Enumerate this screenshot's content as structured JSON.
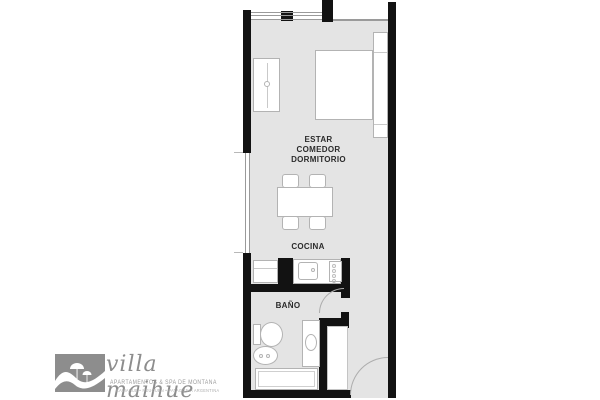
{
  "floorplan": {
    "labels": {
      "living": [
        "ESTAR",
        "COMEDOR",
        "DORMITORIO"
      ],
      "kitchen": "COCINA",
      "bathroom": "BAÑO"
    },
    "colors": {
      "floor": "#e4e4e4",
      "wall": "#121212",
      "fixture_border": "#b3b3b3"
    },
    "fixtures": [
      "wardrobe",
      "bed",
      "bedside-shelf",
      "dining-table",
      "chair",
      "fridge-cabinet",
      "kitchen-counter",
      "kitchen-sink",
      "stove",
      "toilet",
      "bidet",
      "vanity-sink",
      "bathtub",
      "entry-closet",
      "bathroom-door",
      "entry-door",
      "window"
    ]
  },
  "logo": {
    "brand": "villa maihue",
    "tagline": "APARTAMENTOS & SPA DE MONTAÑA",
    "location": "CAVIAHUE • NEUQUEN • PATAGONIA ARGENTINA",
    "color": "#8d8d8d"
  }
}
